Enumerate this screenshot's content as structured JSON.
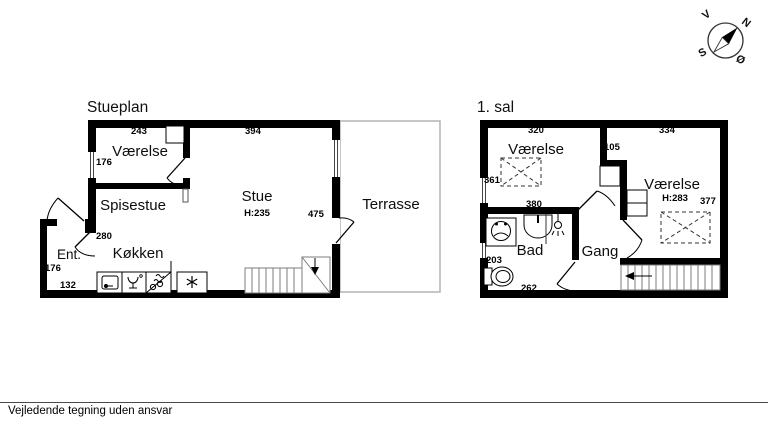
{
  "footer": {
    "note": "Vejledende tegning uden ansvar"
  },
  "compass": {
    "north": "N",
    "south": "S",
    "west": "V",
    "east": "Ø"
  },
  "colors": {
    "wall": "#000000",
    "stair_lines": "#7d7d7d",
    "terrace_border": "#b3b3b3",
    "background": "#ffffff"
  },
  "icons": [
    "compass-rose-icon",
    "sink-icon",
    "dishwasher-icon",
    "cooktop-icon",
    "fridge-snowflake-icon",
    "washing-machine-icon",
    "washbasin-icon",
    "shower-icon",
    "toilet-icon",
    "stairs-down-arrow-icon",
    "stairs-direction-arrow-icon",
    "low-ceiling-cross-marker"
  ],
  "stueplan": {
    "title": "Stueplan",
    "rooms": {
      "vaerelse": "Værelse",
      "spisestue": "Spisestue",
      "stue": "Stue",
      "stue_ceiling_height": "H:235",
      "koekken": "Køkken",
      "ent": "Ent.",
      "terrasse": "Terrasse"
    },
    "dims": {
      "vaerelse_width": "243",
      "stue_width": "394",
      "vaerelse_window": "176",
      "koekken": "280",
      "ent_height": "176",
      "ent_width": "132",
      "stue_depth": "475"
    }
  },
  "sal1": {
    "title": "1. sal",
    "rooms": {
      "vaerelse_left": "Værelse",
      "vaerelse_right": "Værelse",
      "vaerelse_right_ceiling_height": "H:283",
      "bad": "Bad",
      "gang": "Gang"
    },
    "dims": {
      "left_width": "320",
      "right_width": "334",
      "notch": "105",
      "left_depth": "361",
      "mid_width": "380",
      "right_depth": "377",
      "bad_height": "203",
      "bad_width": "262"
    }
  }
}
